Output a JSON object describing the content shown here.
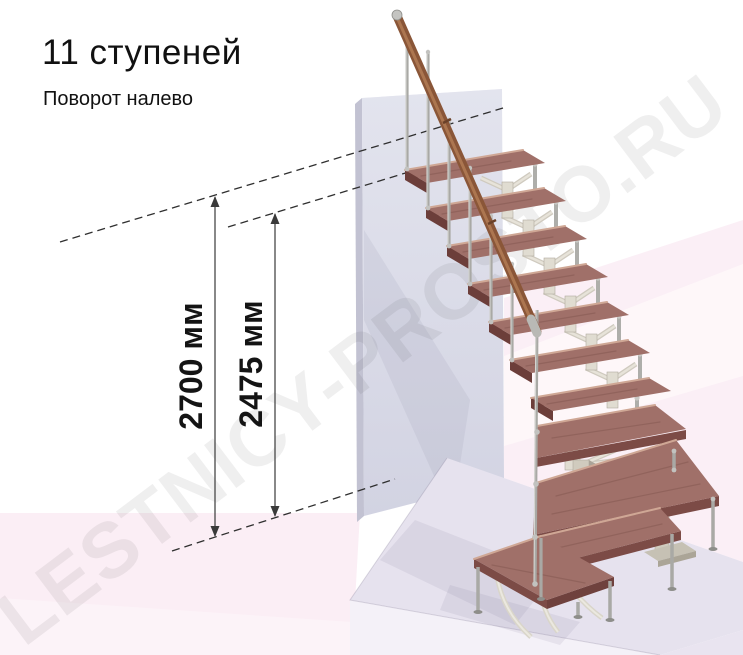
{
  "header": {
    "title": "11 ступеней",
    "subtitle": "Поворот налево"
  },
  "annotations": {
    "dim_total_height": "2700 мм",
    "dim_upper_height": "2475 мм"
  },
  "watermark": "LESTNICY-PROSTO.RU",
  "stair": {
    "steps_count": "11",
    "turn_direction": "налево"
  },
  "colors": {
    "tread_top": "#a07069",
    "tread_front": "#7c4b46",
    "handrail": "#8a5638",
    "wall": "#dcdde9",
    "floor_pink": "#fbeef5",
    "plinth": "#e6e2ee",
    "metal": "#a9a9a5",
    "dimension_text": "#141414"
  }
}
